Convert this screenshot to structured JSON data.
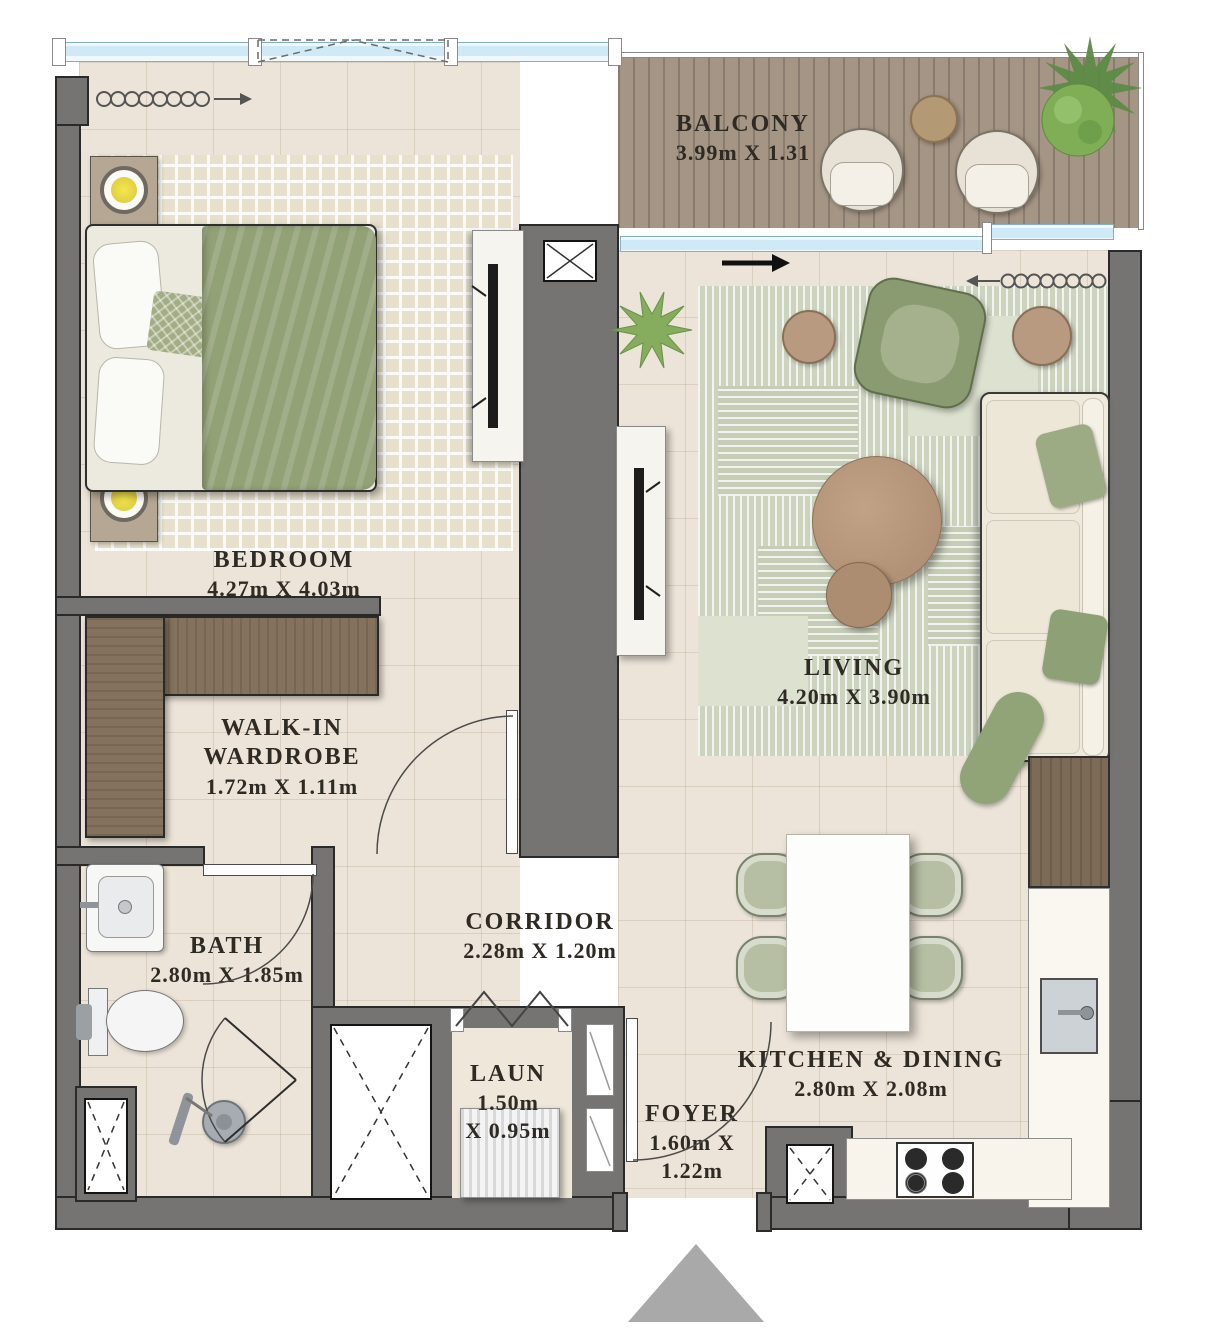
{
  "title": "One-bedroom apartment floor plan",
  "rooms": {
    "balcony": {
      "name": "BALCONY",
      "dims": "3.99m X 1.31"
    },
    "bedroom": {
      "name": "BEDROOM",
      "dims": "4.27m X 4.03m"
    },
    "living": {
      "name": "LIVING",
      "dims": "4.20m X 3.90m"
    },
    "wardrobe": {
      "name": "WALK-IN\nWARDROBE",
      "dims": "1.72m X 1.11m"
    },
    "bath": {
      "name": "BATH",
      "dims": "2.80m X 1.85m"
    },
    "corridor": {
      "name": "CORRIDOR",
      "dims": "2.28m X 1.20m"
    },
    "laundry": {
      "name": "LAUN",
      "dims": "1.50m\nX 0.95m"
    },
    "foyer": {
      "name": "FOYER",
      "dims": "1.60m X\n1.22m"
    },
    "kitchen": {
      "name": "KITCHEN & DINING",
      "dims": "2.80m X 2.08m"
    }
  },
  "icons": {
    "entry_marker": "up-triangle",
    "shaft": "x-box",
    "curtain": "squiggle-arrow",
    "slide_direction": "bold-right-arrow"
  },
  "colors": {
    "wall": "#767472",
    "floor_tile": "#ece4d8",
    "window_glass": "#cfe9f6",
    "balcony_wood": "#a59585",
    "bedroom_rug": "#e7e0cd",
    "living_rug": "#ccd3be",
    "wardrobe_wood": "#84725d",
    "cabinet_wood": "#7c6b57",
    "table_wood": "#b7977c",
    "greenery": "#7fae57",
    "upholstery_green": "#8d9c74",
    "fabric_cream": "#efe9dc",
    "label_text": "#2e2a24",
    "entry_marker_gray": "#a9a9a9"
  }
}
